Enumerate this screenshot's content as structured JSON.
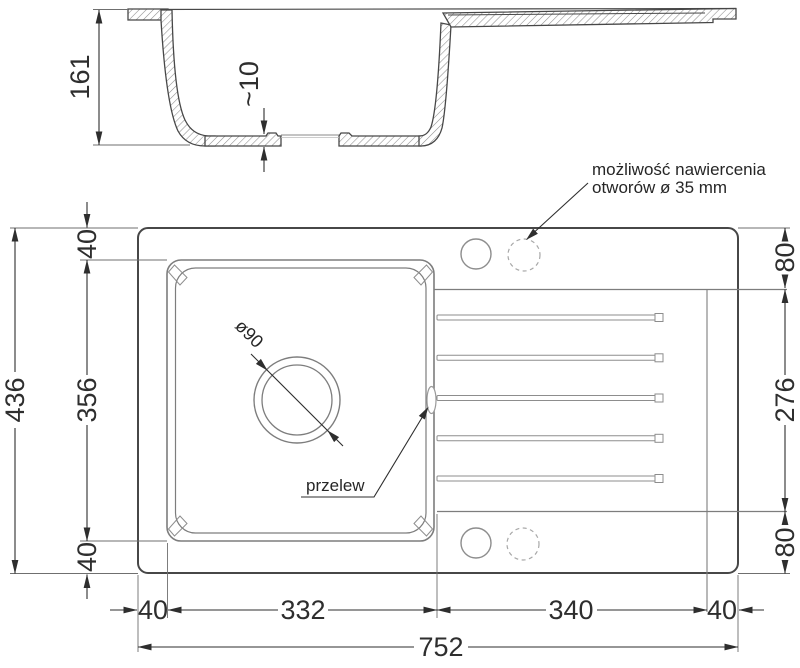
{
  "section": {
    "height": "161",
    "bottom_thickness": "~10"
  },
  "plan": {
    "total_width": "436",
    "bowl_top_offset": "40",
    "bowl_length": "356",
    "bowl_bottom_offset": "40",
    "holes_top_offset": "80",
    "drainer_span": "276",
    "holes_bottom_offset": "80",
    "left_margin": "40",
    "bowl_width": "332",
    "drainer_width": "340",
    "right_margin": "40",
    "total_length": "752",
    "drain_diameter": "ø90",
    "overflow_label": "przelew",
    "note_line1": "możliwość nawiercenia",
    "note_line2": "otworów ø 35 mm"
  },
  "colors": {
    "outline_dark": "#474747",
    "sink_line": "#7d7d7d",
    "dashed_hole": "#a8a8a8",
    "dimension": "#2e2e2e",
    "background": "#ffffff"
  }
}
